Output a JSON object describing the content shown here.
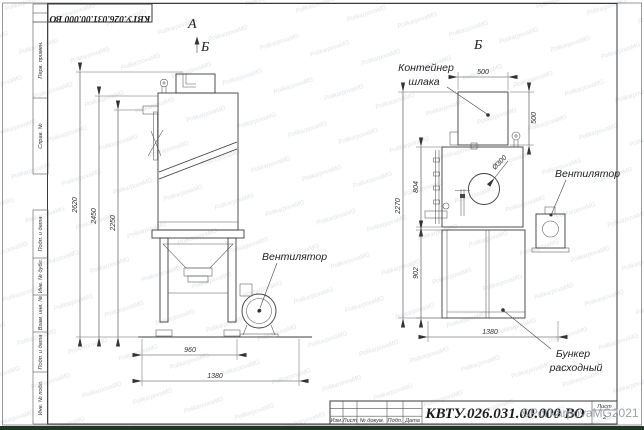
{
  "frame": {
    "stamp_top": "КВТУ.026.031.00.000 ВО",
    "strip_top": [
      "Перв. примен.",
      "Справ. №"
    ],
    "strip_bottom": [
      "Подп. и дата",
      "Инв. № дубл.",
      "Взам. инв. №",
      "Подп. и дата",
      "Инв. № подл."
    ]
  },
  "front_view": {
    "label_a": "А",
    "label_b": "Б",
    "dim_h1": "2620",
    "dim_h2": "2450",
    "dim_h3": "2250",
    "dim_w1": "960",
    "dim_w2": "1380",
    "fan_label": "Вентилятор"
  },
  "section_view": {
    "label": "Б",
    "container_line1": "Контейнер",
    "container_line2": "шлака",
    "dim_top_w": "500",
    "dim_top_h": "500",
    "dim_mid_h": "804",
    "dim_total_h": "2270",
    "dim_low_h": "902",
    "dim_low_w": "1380",
    "dim_dia": "Ø300",
    "fan_label": "Вентилятор",
    "hopper_line1": "Бункер",
    "hopper_line2": "расходный"
  },
  "title_block": {
    "doc_number": "КВТУ.026.031.00.000 ВО",
    "columns": [
      "Изм.",
      "Лист",
      "№ докум.",
      "Подп.",
      "Дата"
    ],
    "sheet_label": "Лист",
    "sheet_number": "2"
  },
  "watermark": {
    "corner": "©PolikarpovaMG2021",
    "tile": "PolikarpovaMG"
  },
  "colors": {
    "line": "#3c3c3c",
    "watermark_tile": "#c3c9d2",
    "watermark_corner": "#9aa0a8",
    "bottom_bar": "#223626"
  }
}
